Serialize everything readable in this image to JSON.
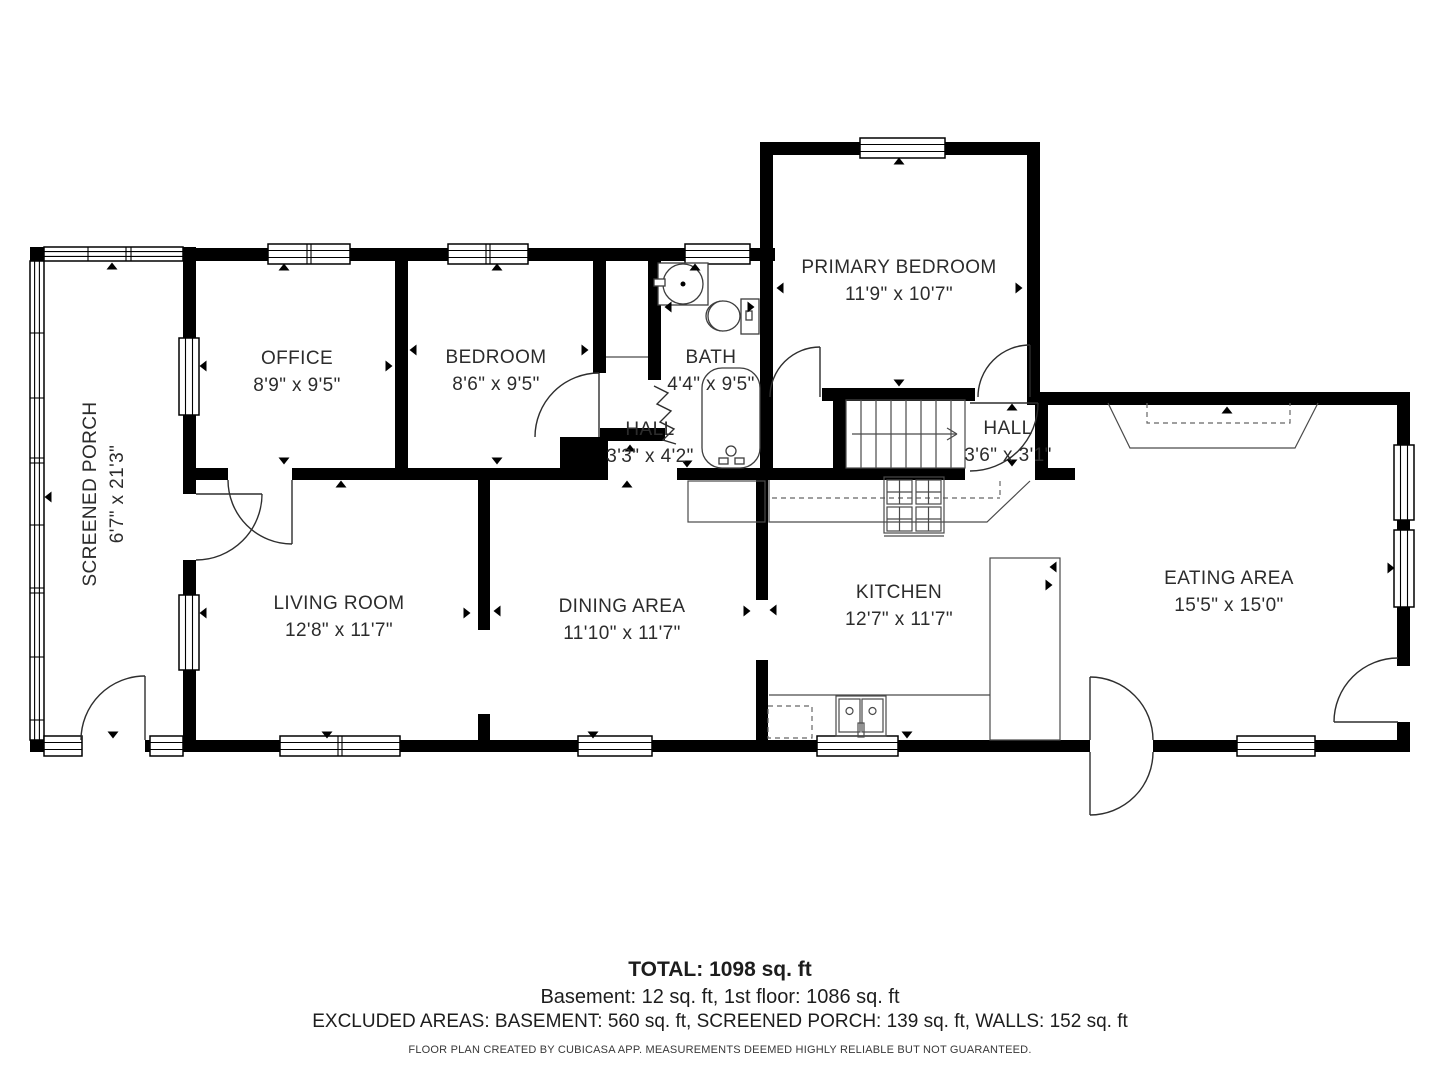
{
  "rooms": [
    {
      "name": "SCREENED PORCH",
      "dims": "6'7\" x 21'3\""
    },
    {
      "name": "OFFICE",
      "dims": "8'9\" x 9'5\""
    },
    {
      "name": "BEDROOM",
      "dims": "8'6\" x 9'5\""
    },
    {
      "name": "BATH",
      "dims": "4'4\" x 9'5\""
    },
    {
      "name": "PRIMARY BEDROOM",
      "dims": "11'9\" x 10'7\""
    },
    {
      "name": "HALL",
      "dims": "3'3\" x 4'2\""
    },
    {
      "name": "HALL",
      "dims": "3'6\" x 3'1\""
    },
    {
      "name": "LIVING ROOM",
      "dims": "12'8\" x 11'7\""
    },
    {
      "name": "DINING AREA",
      "dims": "11'10\" x 11'7\""
    },
    {
      "name": "KITCHEN",
      "dims": "12'7\" x 11'7\""
    },
    {
      "name": "EATING AREA",
      "dims": "15'5\" x 15'0\""
    }
  ],
  "summary": {
    "total": "TOTAL: 1098 sq. ft",
    "breakdown": "Basement: 12 sq. ft, 1st floor: 1086 sq. ft",
    "excluded": "EXCLUDED AREAS: BASEMENT: 560 sq. ft, SCREENED PORCH: 139 sq. ft, WALLS: 152 sq. ft",
    "disclaimer": "FLOOR PLAN CREATED BY CUBICASA APP. MEASUREMENTS DEEMED HIGHLY RELIABLE BUT NOT GUARANTEED."
  },
  "colors": {
    "wall": "#000000",
    "line": "#4a4a4a",
    "text": "#2c2c2c"
  }
}
